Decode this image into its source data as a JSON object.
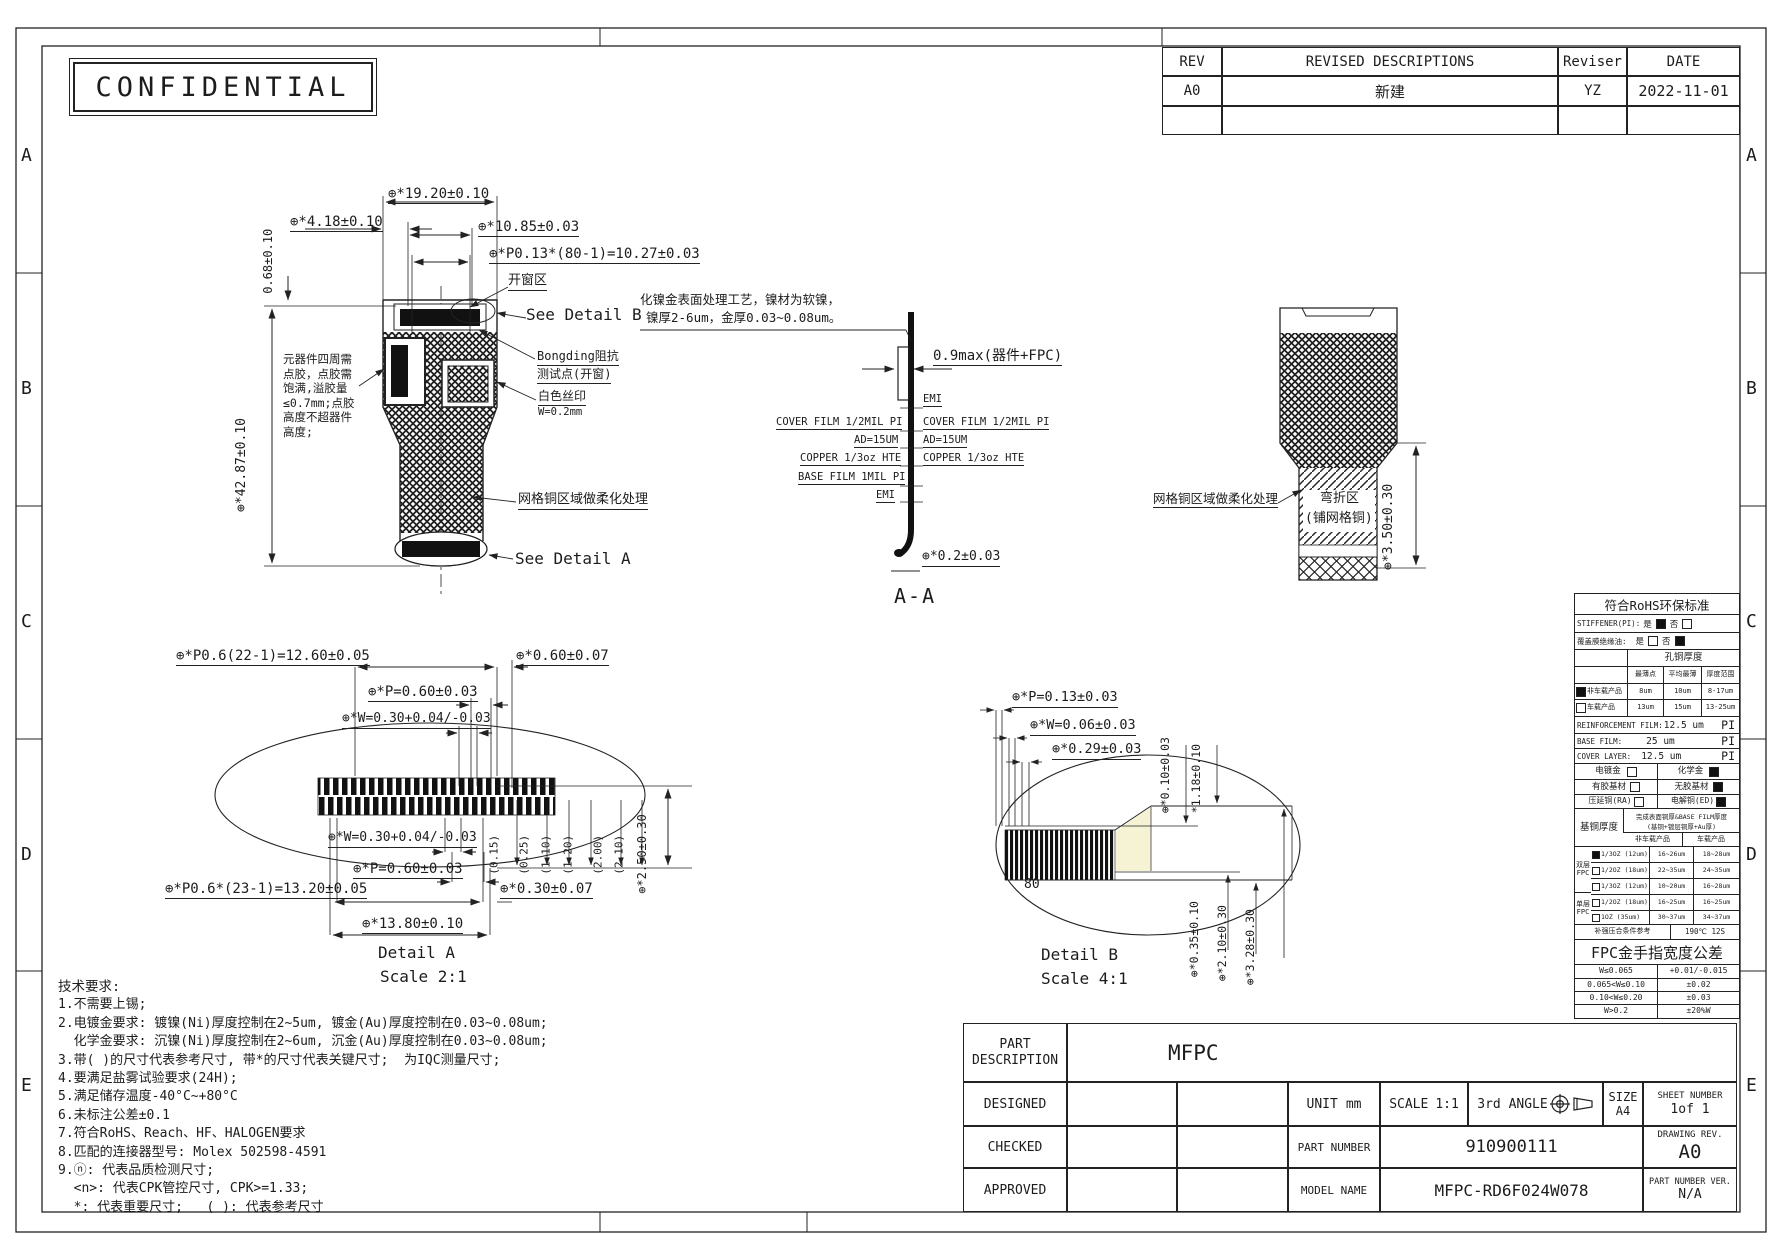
{
  "confidential": "CONFIDENTIAL",
  "grid": {
    "rows": [
      "A",
      "B",
      "C",
      "D",
      "E"
    ]
  },
  "revision_table": {
    "headers": {
      "rev": "REV",
      "desc": "REVISED DESCRIPTIONS",
      "reviser": "Reviser",
      "date": "DATE"
    },
    "rows": [
      {
        "rev": "A0",
        "desc": "新建",
        "reviser": "YZ",
        "date": "2022-11-01"
      }
    ]
  },
  "main_view": {
    "dim_19_20": "⊕*19.20±0.10",
    "dim_4_18": "⊕*4.18±0.10",
    "dim_0_68": "0.68±0.10",
    "dim_10_85": "⊕*10.85±0.03",
    "dim_p013": "⊕*P0.13*(80-1)=10.27±0.03",
    "open_window": "开窗区",
    "see_detail_b": "See Detail B",
    "bonding_1": "Bongding阻抗",
    "bonding_2": "测试点(开窗)",
    "silkscreen_1": "白色丝印",
    "silkscreen_2": "W=0.2mm",
    "glue_note": "元器件四周需\n点胶，点胶需\n饱满,溢胶量\n≤0.7mm;点胶\n高度不超器件\n高度;",
    "dim_42_87": "⊕*42.87±0.10",
    "mesh_note": "网格铜区域做柔化处理",
    "see_detail_a": "See Detail A"
  },
  "section_aa": {
    "surface_note_1": "化镍金表面处理工艺，镍材为软镍，",
    "surface_note_2": "镍厚2-6um，金厚0.03~0.08um。",
    "dim_0_9": "0.9max(器件+FPC)",
    "emi_top": "EMI",
    "cover_film_left": "COVER FILM 1/2MIL PI",
    "cover_film_right": "COVER FILM 1/2MIL PI",
    "ad_left": "AD=15UM",
    "ad_right": "AD=15UM",
    "copper_left": "COPPER 1/3oz HTE",
    "copper_right": "COPPER 1/3oz HTE",
    "base_film": "BASE FILM 1MIL PI",
    "emi_bottom": "EMI",
    "dim_0_2": "⊕*0.2±0.03",
    "label": "A-A"
  },
  "bend_view": {
    "mesh_note": "网格铜区域做柔化处理",
    "bend_zone_1": "弯折区",
    "bend_zone_2": "(铺网格铜)",
    "dim_3_50": "⊕*3.50±0.30"
  },
  "detail_a": {
    "dim_p06_22": "⊕*P0.6(22-1)=12.60±0.05",
    "dim_0_60": "⊕*0.60±0.07",
    "dim_p_top": "⊕*P=0.60±0.03",
    "dim_w_top": "⊕*W=0.30+0.04/-0.03",
    "dim_w_bot": "⊕*W=0.30+0.04/-0.03",
    "dim_p_bot": "⊕*P=0.60±0.03",
    "dim_p06_23": "⊕*P0.6*(23-1)=13.20±0.05",
    "dim_0_30": "⊕*0.30±0.07",
    "dim_13_80": "⊕*13.80±0.10",
    "ref_dims": [
      "(0.15)",
      "(0.25)",
      "(1.10)",
      "(1.20)",
      "(2.00)",
      "(2.10)"
    ],
    "dim_2_50": "⊕*2.50±0.30",
    "title": "Detail A",
    "scale": "Scale 2:1"
  },
  "detail_b": {
    "dim_p": "⊕*P=0.13±0.03",
    "dim_w": "⊕*W=0.06±0.03",
    "dim_0_29": "⊕*0.29±0.03",
    "dim_0_10": "⊕*0.10±0.03",
    "dim_1_18": "*1.18±0.10",
    "pin_count": "80",
    "dim_0_35": "⊕*0.35±0.10",
    "dim_2_10": "⊕*2.10±0.30",
    "dim_3_28": "⊕*3.28±0.30",
    "title": "Detail B",
    "scale": "Scale 4:1"
  },
  "spec_table": {
    "rohs_header": "符合RoHS环保标准",
    "stiffener_label": "STIFFENER(PI):",
    "yes": "是",
    "no": "否",
    "coverlay_label": "覆盖膜绝缘油:",
    "hole_copper_header": "孔铜厚度",
    "hole_cols": [
      "最薄点",
      "平均最薄",
      "厚度范围"
    ],
    "hole_rows": [
      {
        "label": "非车载产品",
        "v": [
          "8um",
          "10um",
          "8-17um"
        ]
      },
      {
        "label": "车载产品",
        "v": [
          "13um",
          "15um",
          "13-25um"
        ]
      }
    ],
    "reinforcement_label": "REINFORCEMENT FILM:",
    "reinforcement_value": "12.5 um",
    "base_film_label": "BASE FILM:",
    "base_film_value": "25 um",
    "cover_layer_label": "COVER LAYER:",
    "cover_layer_value": "12.5 um",
    "pi": "PI",
    "plating_left": "电镀金",
    "plating_right": "化学金",
    "adhesive_left": "有胶基材",
    "adhesive_right": "无胶基材",
    "copper_type_left": "压延铜(RA)",
    "copper_type_right": "电解铜(ED)",
    "base_copper": "基铜厚度",
    "base_copper_note_1": "完成表面铜厚&BASE FILM厚度",
    "base_copper_note_2": "(基铜+镀层铜厚+Au厚)",
    "col_non_auto": "非车载产品",
    "col_auto": "车载产品",
    "double_fpc": "双层\nFPC",
    "single_fpc": "单层\nFPC",
    "copper_rows": [
      {
        "label": "1/3OZ (12um)",
        "non": "16~26um",
        "auto": "18~28um"
      },
      {
        "label": "1/2OZ (18um)",
        "non": "22~35um",
        "auto": "24~35um"
      },
      {
        "label": "1/3OZ (12um)",
        "non": "10~20um",
        "auto": "16~28um"
      },
      {
        "label": "1/2OZ (18um)",
        "non": "16~25um",
        "auto": "16~25um"
      },
      {
        "label": "1OZ (35um)",
        "non": "30~37um",
        "auto": "34~37um"
      }
    ],
    "press_label": "补强压合条件参考",
    "press_value": "190℃ 12S",
    "finger_header": "FPC金手指宽度公差",
    "finger_rows": [
      {
        "range": "W≤0.065",
        "tol": "+0.01/-0.015"
      },
      {
        "range": "0.065<W≤0.10",
        "tol": "±0.02"
      },
      {
        "range": "0.10<W≤0.20",
        "tol": "±0.03"
      },
      {
        "range": "W>0.2",
        "tol": "±20%W"
      }
    ]
  },
  "notes": {
    "title": "技术要求:",
    "lines": [
      "1.不需要上锡;",
      "2.电镀金要求: 镀镍(Ni)厚度控制在2~5um, 镀金(Au)厚度控制在0.03~0.08um;",
      "  化学金要求: 沉镍(Ni)厚度控制在2~6um, 沉金(Au)厚度控制在0.03~0.08um;",
      "3.带( )的尺寸代表参考尺寸, 带*的尺寸代表关键尺寸;  为IQC测量尺寸;",
      "4.要满足盐雾试验要求(24H);",
      "5.满足储存温度-40°C~+80°C",
      "6.未标注公差±0.1",
      "7.符合RoHS、Reach、HF、HALOGEN要求",
      "8.匹配的连接器型号: Molex 502598-4591",
      "9.ⓝ: 代表品质检测尺寸;",
      "  <n>: 代表CPK管控尺寸, CPK>=1.33;",
      "  *: 代表重要尺寸;   ( ): 代表参考尺寸"
    ]
  },
  "title_block": {
    "part_description_label": "PART DESCRIPTION",
    "part_description_value": "MFPC",
    "designed": "DESIGNED",
    "checked": "CHECKED",
    "approved": "APPROVED",
    "unit_label": "UNIT",
    "unit_value": "mm",
    "scale_label": "SCALE",
    "scale_value": "1:1",
    "angle_label": "3rd ANGLE",
    "size_label": "SIZE",
    "size_value": "A4",
    "sheet_label": "SHEET NUMBER",
    "sheet_value": "1of 1",
    "part_number_label": "PART NUMBER",
    "part_number_value": "910900111",
    "drawing_rev_label": "DRAWING REV.",
    "drawing_rev_value": "A0",
    "model_name_label": "MODEL NAME",
    "model_name_value": "MFPC-RD6F024W078",
    "part_number_ver_label": "PART NUMBER VER.",
    "part_number_ver_value": "N/A"
  }
}
